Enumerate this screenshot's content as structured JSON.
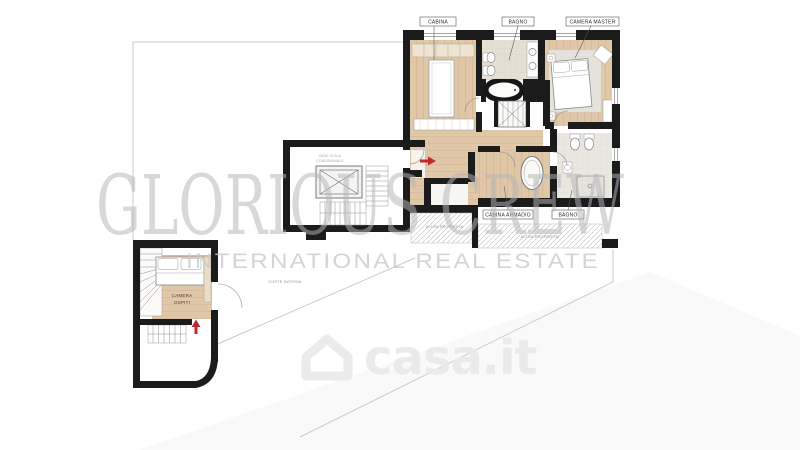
{
  "watermarks": {
    "brand": "GLORIOUS CREW",
    "tagline": "INTERNATIONAL REAL ESTATE",
    "portal": "casa.it"
  },
  "labels": {
    "cabina": "CABINA",
    "bagno_top": "BAGNO",
    "camera_master": "CAMERA MASTER",
    "cabina_armadio": "CABINA ARMADIO",
    "bagno_lower": "BAGNO",
    "camera_ospiti_line1": "CAMERA",
    "camera_ospiti_line2": "OSPITI"
  },
  "annotations": {
    "altra_proprieta_left": "ALTRA PROPRIETA'",
    "altra_proprieta_right": "ALTRA PROPRIETA'",
    "corte_interna": "CORTE INTERNA",
    "stairwell_line1": "VANO SCALA",
    "stairwell_line2": "CONDOMINIALE"
  },
  "colors": {
    "wall": "#1b1b1b",
    "wood_floor": "#dfc7a7",
    "tile_floor": "#e6dfd3",
    "arrow_red": "#c1272d",
    "boundary_gray": "#c9c9c9",
    "watermark_brand": "#b5b5ba",
    "watermark_tagline": "#cacace",
    "watermark_portal": "#eaeaed"
  }
}
